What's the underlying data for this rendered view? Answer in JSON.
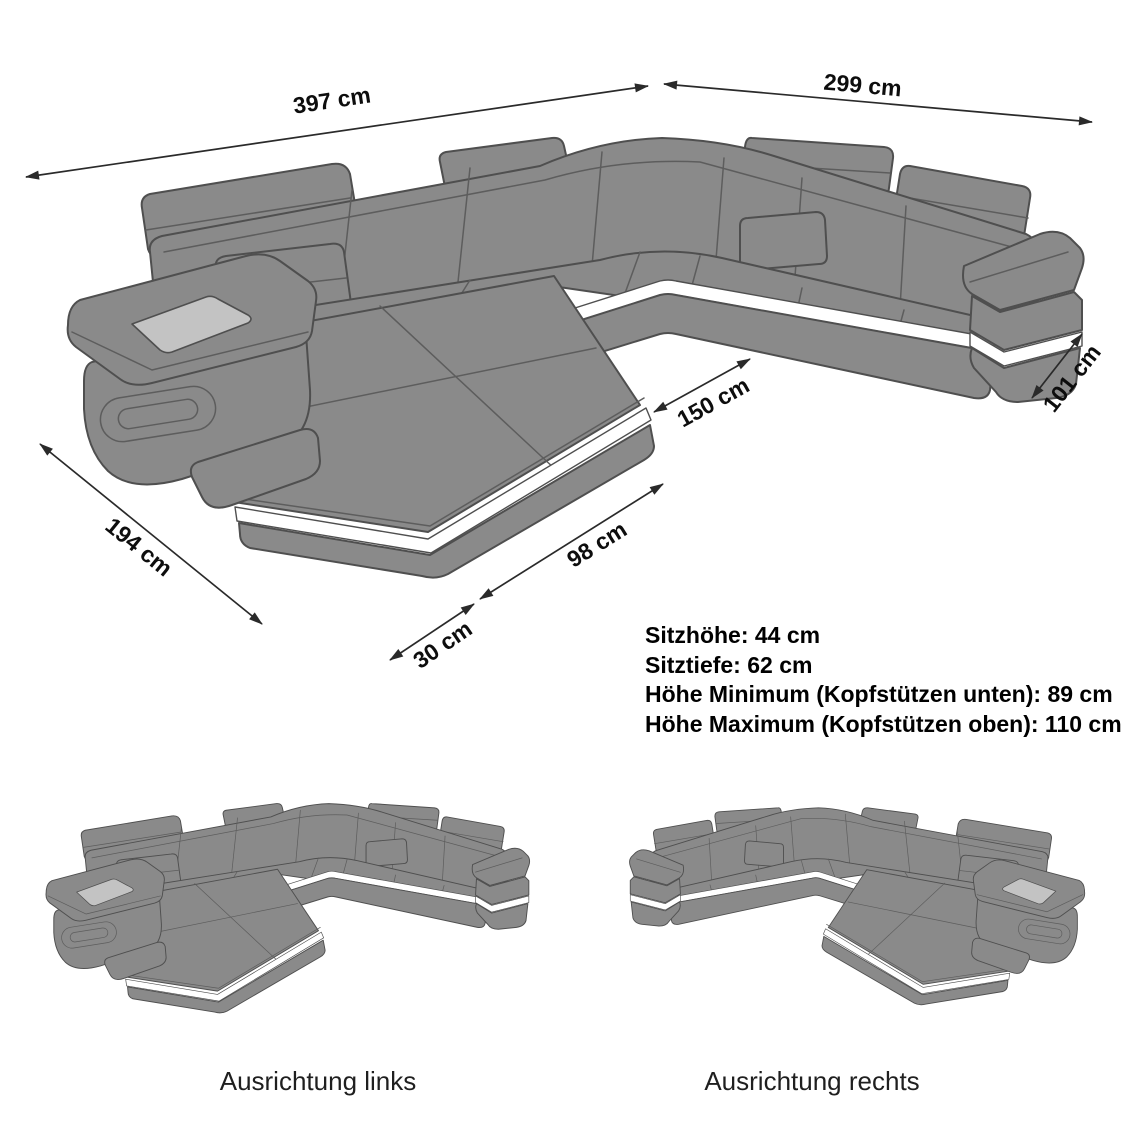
{
  "dimensions": [
    {
      "id": "back-width-left",
      "label": "397 cm"
    },
    {
      "id": "back-width-right",
      "label": "299 cm"
    },
    {
      "id": "inner-depth",
      "label": "150 cm"
    },
    {
      "id": "right-end-depth",
      "label": "101 cm"
    },
    {
      "id": "chaise-length",
      "label": "194 cm"
    },
    {
      "id": "front-offset",
      "label": "30 cm"
    },
    {
      "id": "chaise-front",
      "label": "98 cm"
    }
  ],
  "specs": {
    "lines": [
      "Sitzhöhe: 44 cm",
      "Sitztiefe: 62 cm",
      "Höhe Minimum (Kopfstützen unten): 89 cm",
      "Höhe Maximum (Kopfstützen oben): 110 cm"
    ]
  },
  "variants": {
    "left_label": "Ausrichtung links",
    "right_label": "Ausrichtung rechts"
  },
  "colors": {
    "sofa_fill": "#8a8a8a",
    "sofa_stroke": "#4f4f4f",
    "seam": "#5d5d5d",
    "accent_panel": "#c3c3c3",
    "led_strip": "#ffffff",
    "dimension_line": "#2a2a2a",
    "text": "#000000"
  }
}
